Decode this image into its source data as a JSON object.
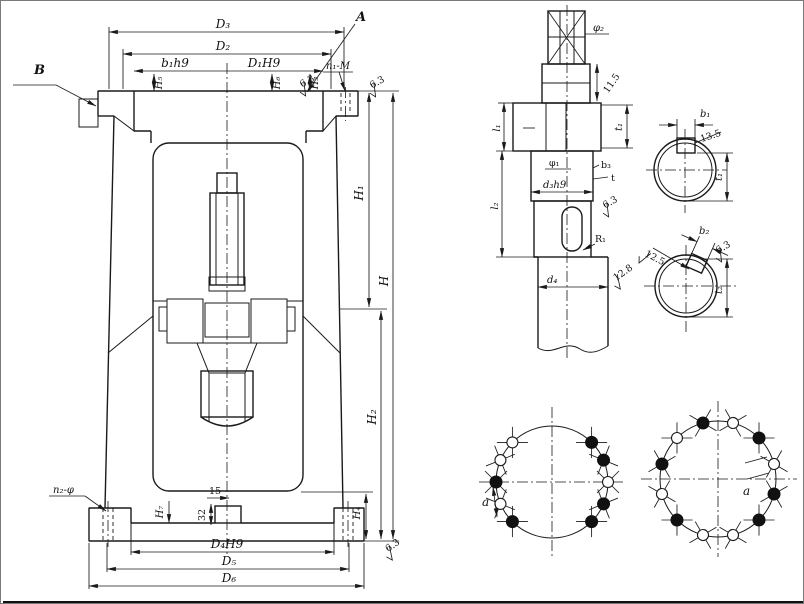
{
  "main_view": {
    "top_dims": {
      "d3": "D₃",
      "d2": "D₂",
      "b1h9": "b₁h9",
      "d1h9": "D₁H9",
      "h5": "H₅",
      "h6": "H₆",
      "h3": "H₃",
      "n1_m": "n₁-M",
      "rough_left": "6.3",
      "rough_right": "6.3"
    },
    "view_labels": {
      "a": "A",
      "b": "B"
    },
    "right_dims": {
      "h1": "H₁",
      "h": "H",
      "h2": "H₂",
      "h4": "H₄",
      "rough_base": "6.3"
    },
    "bottom_dims": {
      "n2_phi": "n₂-φ",
      "h7": "H₇",
      "dim32": "32",
      "dim15": "15",
      "d4h9": "D₄H9",
      "d5": "D₅",
      "d6": "D₆"
    }
  },
  "shaft_view": {
    "phi2": "φ₂",
    "dim115": "11.5",
    "t1": "t₁",
    "l1": "l₁",
    "l2": "l₂",
    "phi1": "φ₁",
    "d3h9": "d₃h9",
    "b3": "b₃",
    "t": "t",
    "rough63": "6.3",
    "r1": "R₁",
    "rough128": "12.8",
    "d4": "d₄"
  },
  "section_a": {
    "b1": "b₁",
    "dim135": "13.5",
    "t1": "t₁"
  },
  "section_b": {
    "b2": "b₂",
    "t2": "t₂",
    "rough125": "12.5",
    "rough63": "6.3"
  },
  "bolt_circle_left": {
    "angle": "a"
  },
  "bolt_circle_right": {
    "angle": "a"
  }
}
